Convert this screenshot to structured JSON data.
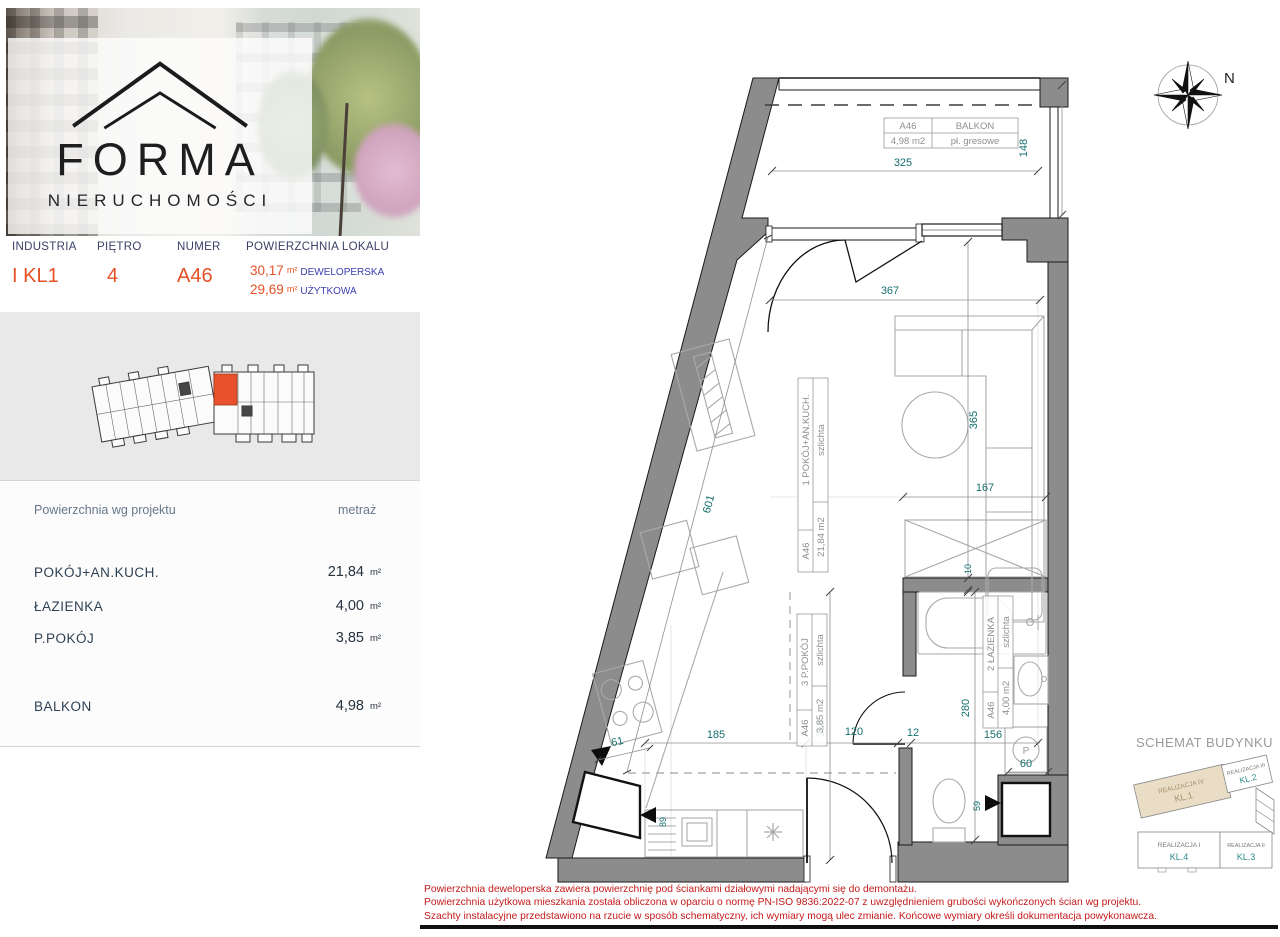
{
  "brand": {
    "name": "FORMA",
    "subtitle": "NIERUCHOMOŚCI"
  },
  "info": {
    "headers": [
      "INDUSTRIA",
      "PIĘTRO",
      "NUMER",
      "POWIERZCHNIA LOKALU"
    ],
    "building": "I KL1",
    "floor": "4",
    "unit": "A46",
    "areas": [
      {
        "value": "30,17",
        "unit": "m²",
        "label": "DEWELOPERSKA"
      },
      {
        "value": "29,69",
        "unit": "m²",
        "label": "UŻYTKOWA"
      }
    ]
  },
  "areas_table": {
    "header_left": "Powierzchnia wg projektu",
    "header_right": "metraż",
    "rows": [
      {
        "label": "POKÓJ+AN.KUCH.",
        "value": "21,84",
        "unit": "m²"
      },
      {
        "label": "ŁAZIENKA",
        "value": "4,00",
        "unit": "m²"
      },
      {
        "label": "P.POKÓJ",
        "value": "3,85",
        "unit": "m²"
      },
      {
        "label": "BALKON",
        "value": "4,98",
        "unit": "m²"
      }
    ]
  },
  "plan": {
    "labels": {
      "balcony": {
        "id": "A46",
        "name": "BALKON",
        "area": "4,98 m2",
        "finish": "pł. gresowe"
      },
      "room": {
        "id": "A46",
        "name": "1 POKÓJ+AN.KUCH.",
        "area": "21,84 m2",
        "finish": "szlichta"
      },
      "hall": {
        "id": "A46",
        "name": "3 P.POKÓJ",
        "area": "3,85 m2",
        "finish": "szlichta"
      },
      "bath": {
        "id": "A46",
        "name": "2 ŁAZIENKA",
        "area": "4,00 m2",
        "finish": "szlichta"
      }
    },
    "dims": {
      "balcony_width": "325",
      "balcony_depth": "148",
      "room_width": "367",
      "room_depth": "365",
      "wall_diag": "601",
      "sofa_wall": "167",
      "gap10": "10",
      "kitchen": "185",
      "hall_len": "319",
      "hall_w": "120",
      "wall12": "12",
      "bath_w": "156",
      "bath_len": "280",
      "washer": "60",
      "d61": "61",
      "d89": "89",
      "d59": "59"
    },
    "compass": "N",
    "washer_symbol": "P"
  },
  "schematic": {
    "title": "SCHEMAT BUDYNKU",
    "blocks": [
      {
        "name": "REALIZACJA IV",
        "kl": "KL.1"
      },
      {
        "name": "REALIZACJA III",
        "kl": "KL.2"
      },
      {
        "name": "REALIZACJA I",
        "kl": "KL.4"
      },
      {
        "name": "REALIZACJA II",
        "kl": "KL.3"
      }
    ]
  },
  "disclaimer": [
    "Powierzchnia deweloperska zawiera powierzchnię pod ściankami działowymi nadającymi się do demontażu.",
    "Powierzchnia użytkowa mieszkania została obliczona w oparciu o normę  PN-ISO 9836:2022-07 z uwzględnieniem grubości wykończonych ścian wg projektu.",
    "Szachty instalacyjne przedstawiono na rzucie w sposób schematyczny, ich wymiary mogą ulec zmianie. Końcowe wymiary określi dokumentacja powykonawcza."
  ],
  "colors": {
    "accent": "#e65125",
    "navy": "#3b3fae",
    "teal": "#166f6f",
    "red": "#c41a1a",
    "wall": "#8c8c8c"
  }
}
